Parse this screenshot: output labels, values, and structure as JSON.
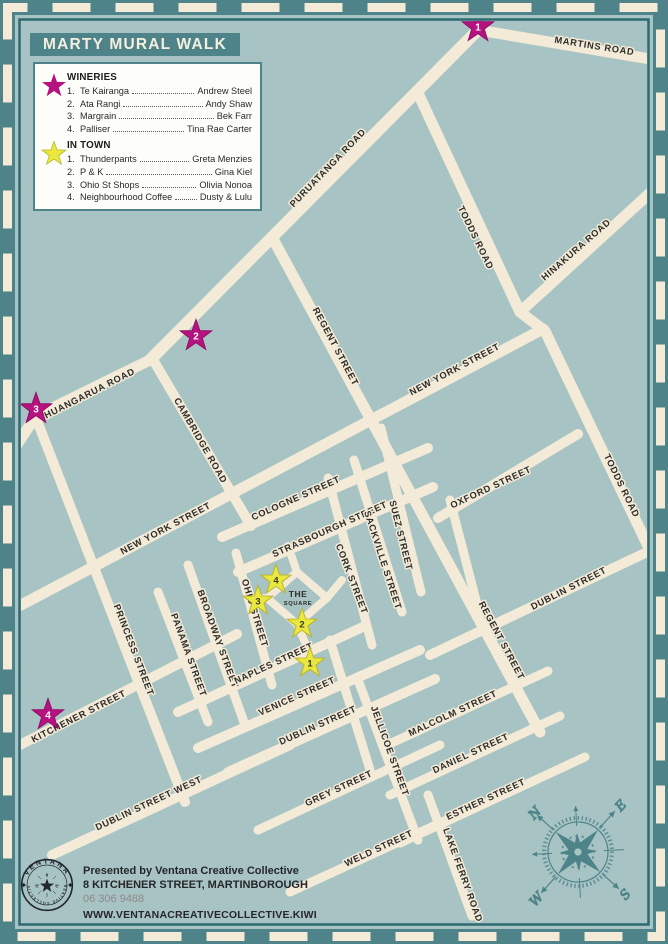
{
  "title": "MARTY MURAL WALK",
  "legend": {
    "wineries": {
      "heading": "WINERIES",
      "items": [
        {
          "num": "1.",
          "name": "Te Kairanga",
          "artist": "Andrew Steel"
        },
        {
          "num": "2.",
          "name": "Ata Rangi",
          "artist": "Andy Shaw"
        },
        {
          "num": "3.",
          "name": "Margrain",
          "artist": "Bek Farr"
        },
        {
          "num": "4.",
          "name": "Palliser",
          "artist": "Tina Rae Carter"
        }
      ]
    },
    "in_town": {
      "heading": "IN TOWN",
      "items": [
        {
          "num": "1.",
          "name": "Thunderpants",
          "artist": "Greta Menzies"
        },
        {
          "num": "2.",
          "name": "P & K",
          "artist": "Gina Kiel"
        },
        {
          "num": "3.",
          "name": "Ohio St Shops",
          "artist": "Olivia Nonoa"
        },
        {
          "num": "4.",
          "name": "Neighbourhood Coffee",
          "artist": "Dusty & Lulu"
        }
      ]
    }
  },
  "map": {
    "road_labels": [
      "MARTINS ROAD",
      "PURUATANGA ROAD",
      "TODDS ROAD",
      "HINAKURA ROAD",
      "REGENT STREET",
      "NEW YORK STREET",
      "HUANGARUA ROAD",
      "CAMBRIDGE ROAD",
      "NEW YORK STREET",
      "COLOGNE STREET",
      "STRASBOURGH STREET",
      "SUEZ STREET",
      "SACKVILLE STREET",
      "OXFORD STREET",
      "TODDS ROAD",
      "CORK STREET",
      "OHIO STREET",
      "BROADWAY STREET",
      "PANAMA STREET",
      "PRINCESS STREET",
      "NAPLES STREET",
      "VENICE STREET",
      "KITCHENER STREET",
      "DUBLIN STREET",
      "DUBLIN STREET",
      "REGENT STREET",
      "MALCOLM STREET",
      "JELLICOE STREET",
      "DANIEL STREET",
      "GREY STREET",
      "ESTHER STREET",
      "DUBLIN STREET WEST",
      "WELD STREET",
      "LAKE FERRY ROAD"
    ],
    "square": {
      "line1": "THE",
      "line2": "SQUARE"
    },
    "winery_stars": [
      "1",
      "2",
      "3",
      "4"
    ],
    "town_stars": [
      "1",
      "2",
      "3",
      "4"
    ]
  },
  "compass": {
    "n": "N",
    "e": "E",
    "s": "S",
    "w": "W"
  },
  "footer": {
    "logo_top": "VENTANA",
    "logo_bottom": "CREATIVE COLLECTIVE",
    "logo_letter_v": "V",
    "logo_letter_c1": "C",
    "logo_letter_c2": "C",
    "line1": "Presented by Ventana Creative Collective",
    "line2": "8 KITCHENER STREET, MARTINBOROUGH",
    "phone": "06 306 9488",
    "website": "WWW.VENTANACREATIVECOLLECTIVE.KIWI"
  },
  "colors": {
    "teal": "#4e8489",
    "map_bg": "#a7c3c3",
    "road_cream": "#f3ead7",
    "border_line": "#2e6a71",
    "winery_star": "#b61280",
    "town_star": "#eae73e",
    "label_text": "#2e2d2a"
  }
}
